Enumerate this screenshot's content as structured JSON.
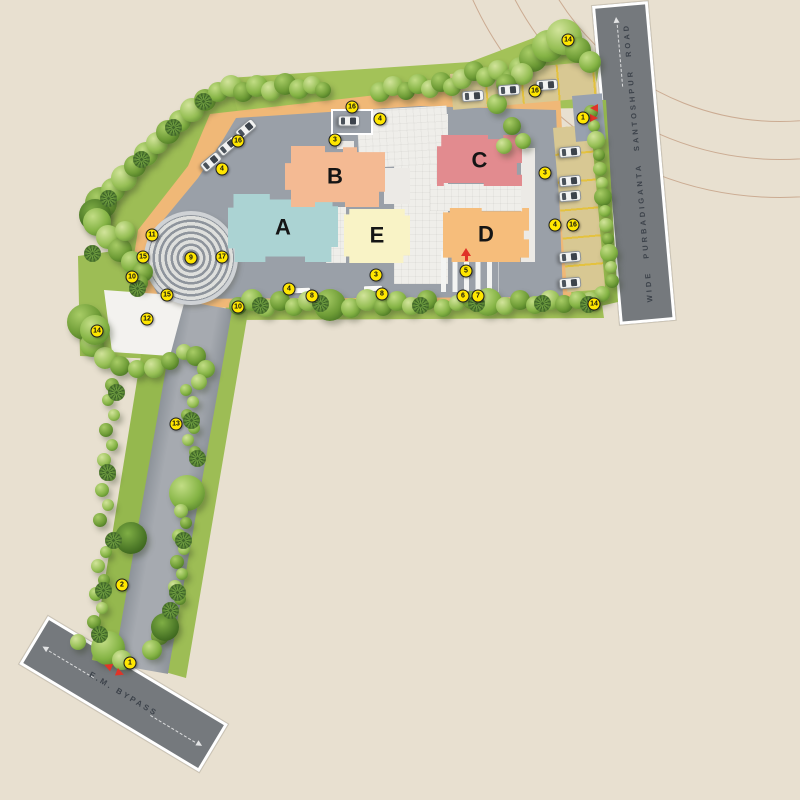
{
  "scene": {
    "background": "#e8e0d0",
    "type": "residential site plan"
  },
  "roads": {
    "santoshpur": {
      "name": "WIDE PURBADIGANTA SANTOSHPUR ROAD"
    },
    "bypass": {
      "name": "E.M. BYPASS"
    }
  },
  "site": {
    "buildings": [
      {
        "label": "A",
        "color": "#abd3d3"
      },
      {
        "label": "B",
        "color": "#f4ba93"
      },
      {
        "label": "C",
        "color": "#e28b8f"
      },
      {
        "label": "D",
        "color": "#f6bd7b"
      },
      {
        "label": "E",
        "color": "#f9f3c6"
      }
    ],
    "markers": [
      {
        "n": "1",
        "x": 583,
        "y": 118
      },
      {
        "n": "1",
        "x": 130,
        "y": 663
      },
      {
        "n": "2",
        "x": 122,
        "y": 585
      },
      {
        "n": "3",
        "x": 335,
        "y": 140
      },
      {
        "n": "3",
        "x": 545,
        "y": 173
      },
      {
        "n": "3",
        "x": 376,
        "y": 275
      },
      {
        "n": "4",
        "x": 222,
        "y": 169
      },
      {
        "n": "4",
        "x": 380,
        "y": 119
      },
      {
        "n": "4",
        "x": 555,
        "y": 225
      },
      {
        "n": "4",
        "x": 289,
        "y": 289
      },
      {
        "n": "5",
        "x": 466,
        "y": 271
      },
      {
        "n": "6",
        "x": 463,
        "y": 296
      },
      {
        "n": "7",
        "x": 478,
        "y": 296
      },
      {
        "n": "8",
        "x": 312,
        "y": 296
      },
      {
        "n": "8",
        "x": 382,
        "y": 294
      },
      {
        "n": "9",
        "x": 191,
        "y": 258
      },
      {
        "n": "10",
        "x": 132,
        "y": 277
      },
      {
        "n": "10",
        "x": 238,
        "y": 307
      },
      {
        "n": "11",
        "x": 152,
        "y": 235
      },
      {
        "n": "12",
        "x": 147,
        "y": 319
      },
      {
        "n": "13",
        "x": 176,
        "y": 424
      },
      {
        "n": "14",
        "x": 568,
        "y": 40
      },
      {
        "n": "14",
        "x": 97,
        "y": 331
      },
      {
        "n": "14",
        "x": 594,
        "y": 304
      },
      {
        "n": "15",
        "x": 143,
        "y": 257
      },
      {
        "n": "15",
        "x": 167,
        "y": 295
      },
      {
        "n": "16",
        "x": 238,
        "y": 141
      },
      {
        "n": "16",
        "x": 352,
        "y": 107
      },
      {
        "n": "16",
        "x": 535,
        "y": 91
      },
      {
        "n": "16",
        "x": 573,
        "y": 225
      },
      {
        "n": "17",
        "x": 222,
        "y": 257
      }
    ],
    "vehicles": [
      {
        "x": 570,
        "y": 152,
        "r": 85
      },
      {
        "x": 570,
        "y": 181,
        "r": 85
      },
      {
        "x": 570,
        "y": 196,
        "r": 85
      },
      {
        "x": 570,
        "y": 257,
        "r": 85
      },
      {
        "x": 570,
        "y": 283,
        "r": 85
      },
      {
        "x": 473,
        "y": 96,
        "r": 86
      },
      {
        "x": 509,
        "y": 90,
        "r": 86
      },
      {
        "x": 547,
        "y": 85,
        "r": 86
      },
      {
        "x": 349,
        "y": 121,
        "r": 90
      },
      {
        "x": 246,
        "y": 129,
        "r": 50
      },
      {
        "x": 228,
        "y": 146,
        "r": 50
      },
      {
        "x": 211,
        "y": 162,
        "r": 50
      }
    ]
  },
  "colors": {
    "marker": "#ffe600",
    "pathway": "#f0b877",
    "driveway": "#9aa0a8",
    "road": "#75797d",
    "grass": "#a3c258",
    "parking_stall": "#d8c893",
    "plaza": "#efeeea",
    "entry_arrow": "#e03428"
  }
}
